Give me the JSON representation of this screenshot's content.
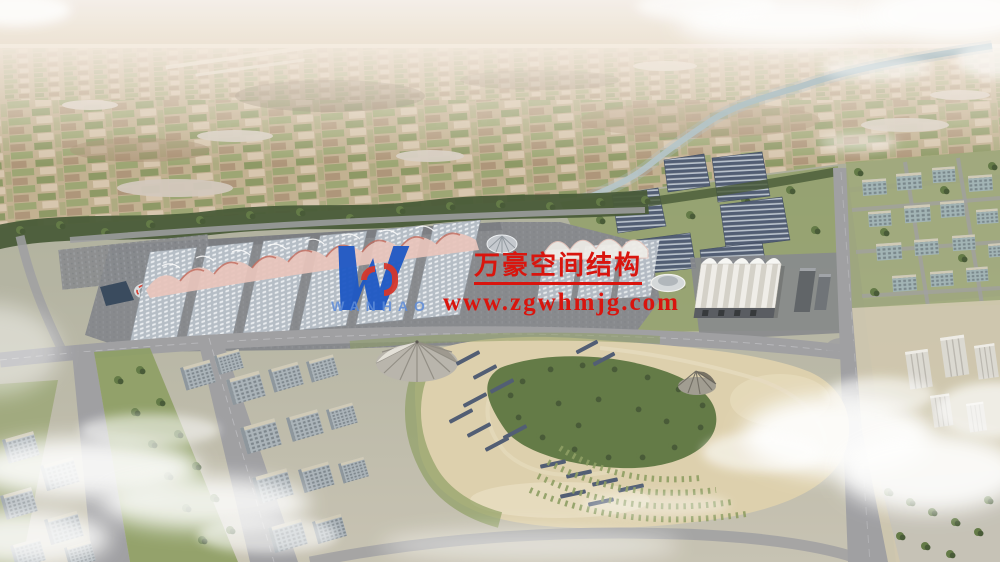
{
  "watermark": {
    "company_name": "万豪空间结构",
    "website_url": "www.zgwhmjg.com",
    "logo_text": "WANHAO"
  },
  "palette": {
    "sky_top": "#f5efe9",
    "sky_horizon": "#eadcc9",
    "plain_base": "#c0ae8e",
    "plain_far": "#d7c6ae",
    "plain_green": "#93a169",
    "plain_green2": "#7c8f56",
    "plain_brown": "#a2876a",
    "plain_dark": "#6f5e49",
    "haze": "#f6ece2",
    "river": "#b3c3c9",
    "tree_dark": "#415430",
    "tree_mid": "#5d7540",
    "ground_top": "#a9ab98",
    "ground_bottom": "#c6c1b1",
    "apron": "#83858a",
    "road": "#9c9ca0",
    "road_light": "#c6c6ca",
    "roof_base": "#b4bcc6",
    "roof_dot": "#edf0f4",
    "canopy_pink": "#e8c3ba",
    "canopy_red": "#bf6456",
    "white_roof": "#f0eee9",
    "white_shade": "#d3d0c8",
    "dark_face": "#53565c",
    "solar": "#4a576f",
    "solar_gap": "#b6bfcc",
    "park_sand": "#ddcfab",
    "park_sand2": "#e9ddc0",
    "park_green": "#8a9b5e",
    "pond": "#2c3f55",
    "bldg_face": "#a8b1b8",
    "bldg_side": "#8a939a",
    "bldg_roof": "#cfc9b6",
    "glass_face": "#9fb2b4",
    "tower_white": "#dbd8d1",
    "cloud": "#ffffff",
    "wm_red": "#d9150e",
    "wm_blue": "#1d57c4",
    "wm_blue_light": "#5d8bd8",
    "wm_red2": "#d6382c"
  }
}
